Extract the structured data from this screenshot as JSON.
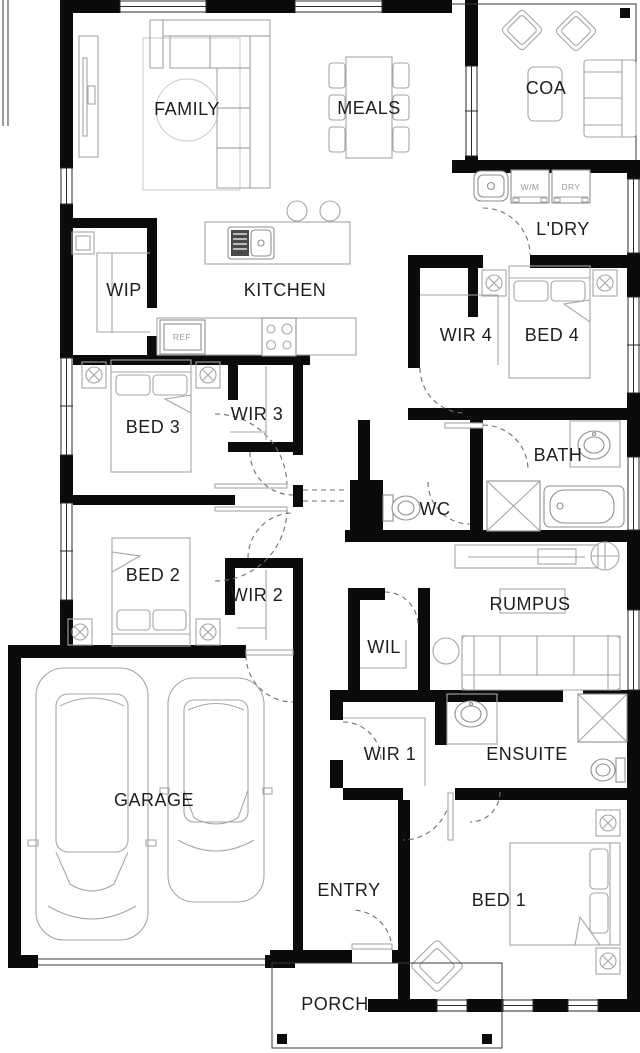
{
  "plan": {
    "title": "House floor plan",
    "labels": {
      "family": "FAMILY",
      "meals": "MEALS",
      "coa": "COA",
      "ldry": "L'DRY",
      "wip": "WIP",
      "kitchen": "KITCHEN",
      "wir4": "WIR 4",
      "bed4": "BED 4",
      "bed3": "BED 3",
      "wir3": "WIR 3",
      "bath": "BATH",
      "wc": "WC",
      "bed2": "BED 2",
      "wir2": "WIR 2",
      "rumpus": "RUMPUS",
      "wil": "WIL",
      "garage": "GARAGE",
      "wir1": "WIR 1",
      "ensuite": "ENSUITE",
      "entry": "ENTRY",
      "bed1": "BED 1",
      "porch": "PORCH"
    },
    "appliances": {
      "wm": "W/M",
      "dry": "DRY",
      "ref": "REF"
    },
    "colors": {
      "wall": "#0b0b0b",
      "furniture": "#a6a6a6",
      "fixture": "#8f8f8f",
      "door": "#6f6f6f",
      "text": "#1e1e1e",
      "muted": "#9a9a9a",
      "bg": "#ffffff"
    }
  }
}
